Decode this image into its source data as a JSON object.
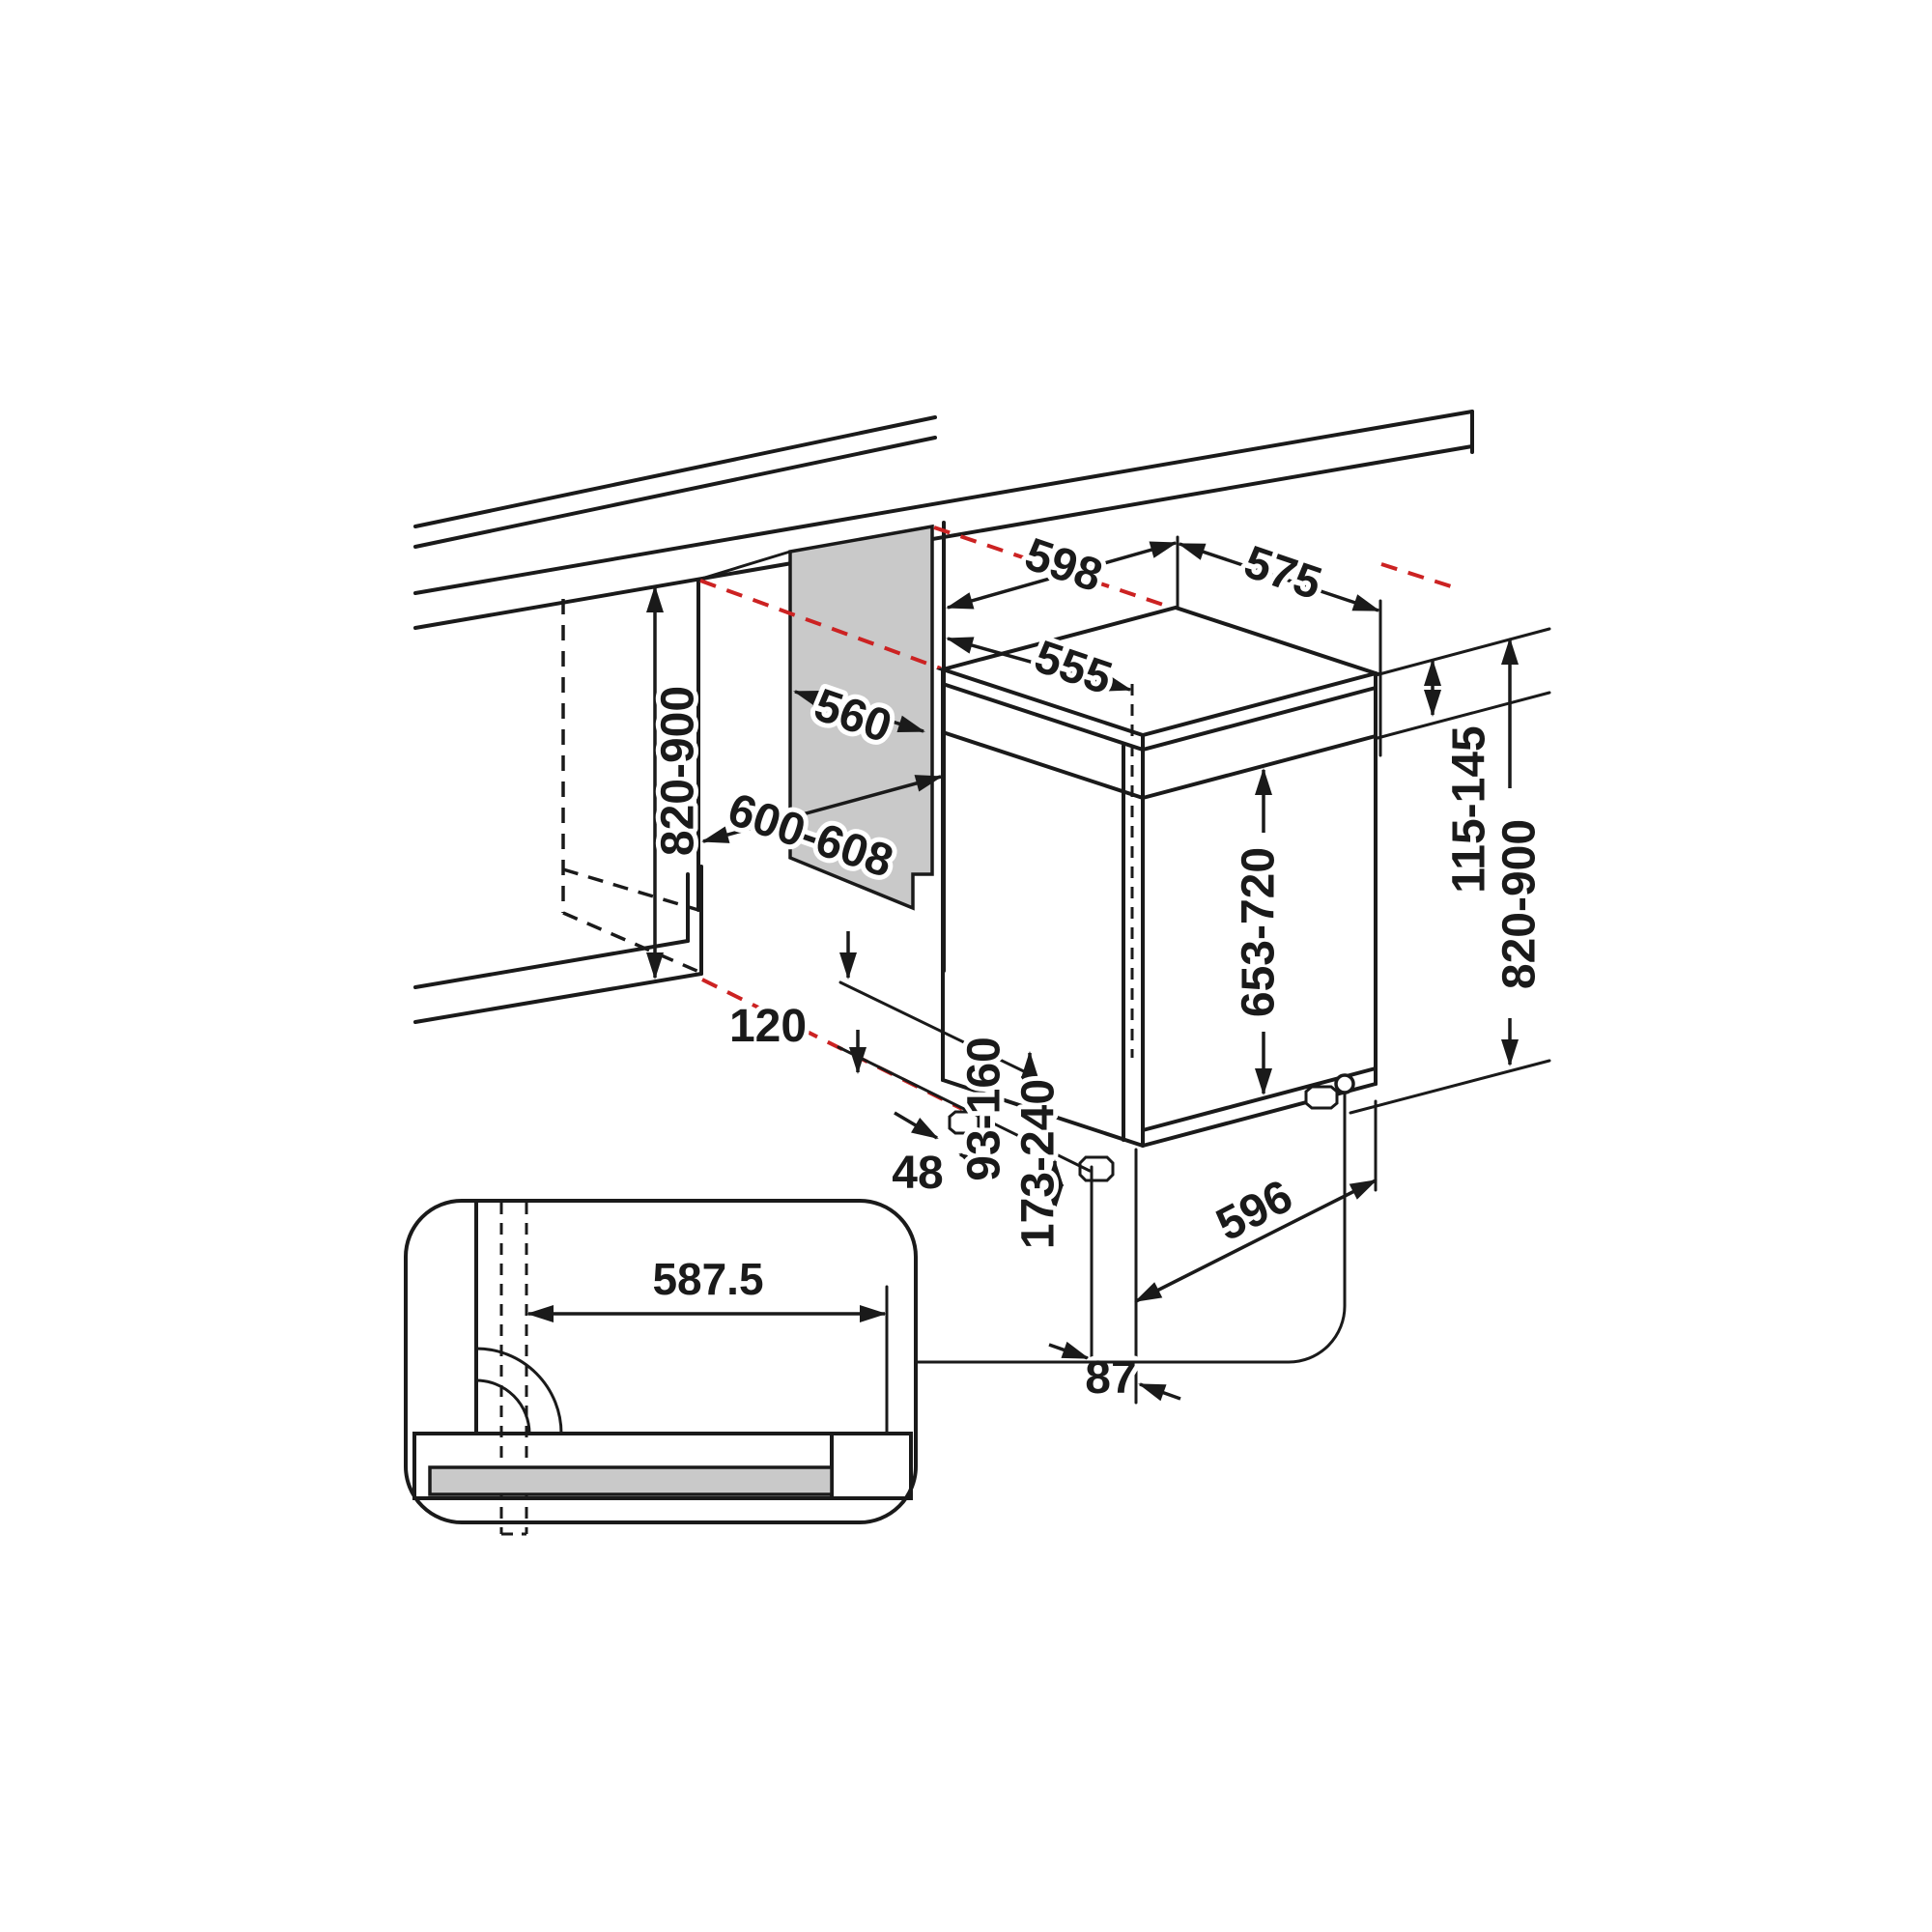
{
  "diagram": {
    "type": "installation-dimension-drawing",
    "subject": "built-under dishwasher installation niche",
    "units": "mm",
    "labels": {
      "niche_width_top": "598",
      "appliance_depth": "575",
      "tub_depth": "555",
      "niche_back_width": "560",
      "niche_opening_width": "600-608",
      "niche_height": "820-900",
      "control_panel_height": "115-145",
      "appliance_height": "820-900",
      "door_height": "653-720",
      "plinth_recess": "120",
      "gap_48": "48",
      "range_93_160": "93-160",
      "range_173_240": "173-240",
      "foot_offset": "87",
      "front_width": "596",
      "detail_offset": "587.5"
    },
    "colors": {
      "line": "#1a1a1a",
      "projection_line": "#cc2222",
      "panel_fill": "#c9c9c9",
      "background": "#ffffff"
    }
  }
}
